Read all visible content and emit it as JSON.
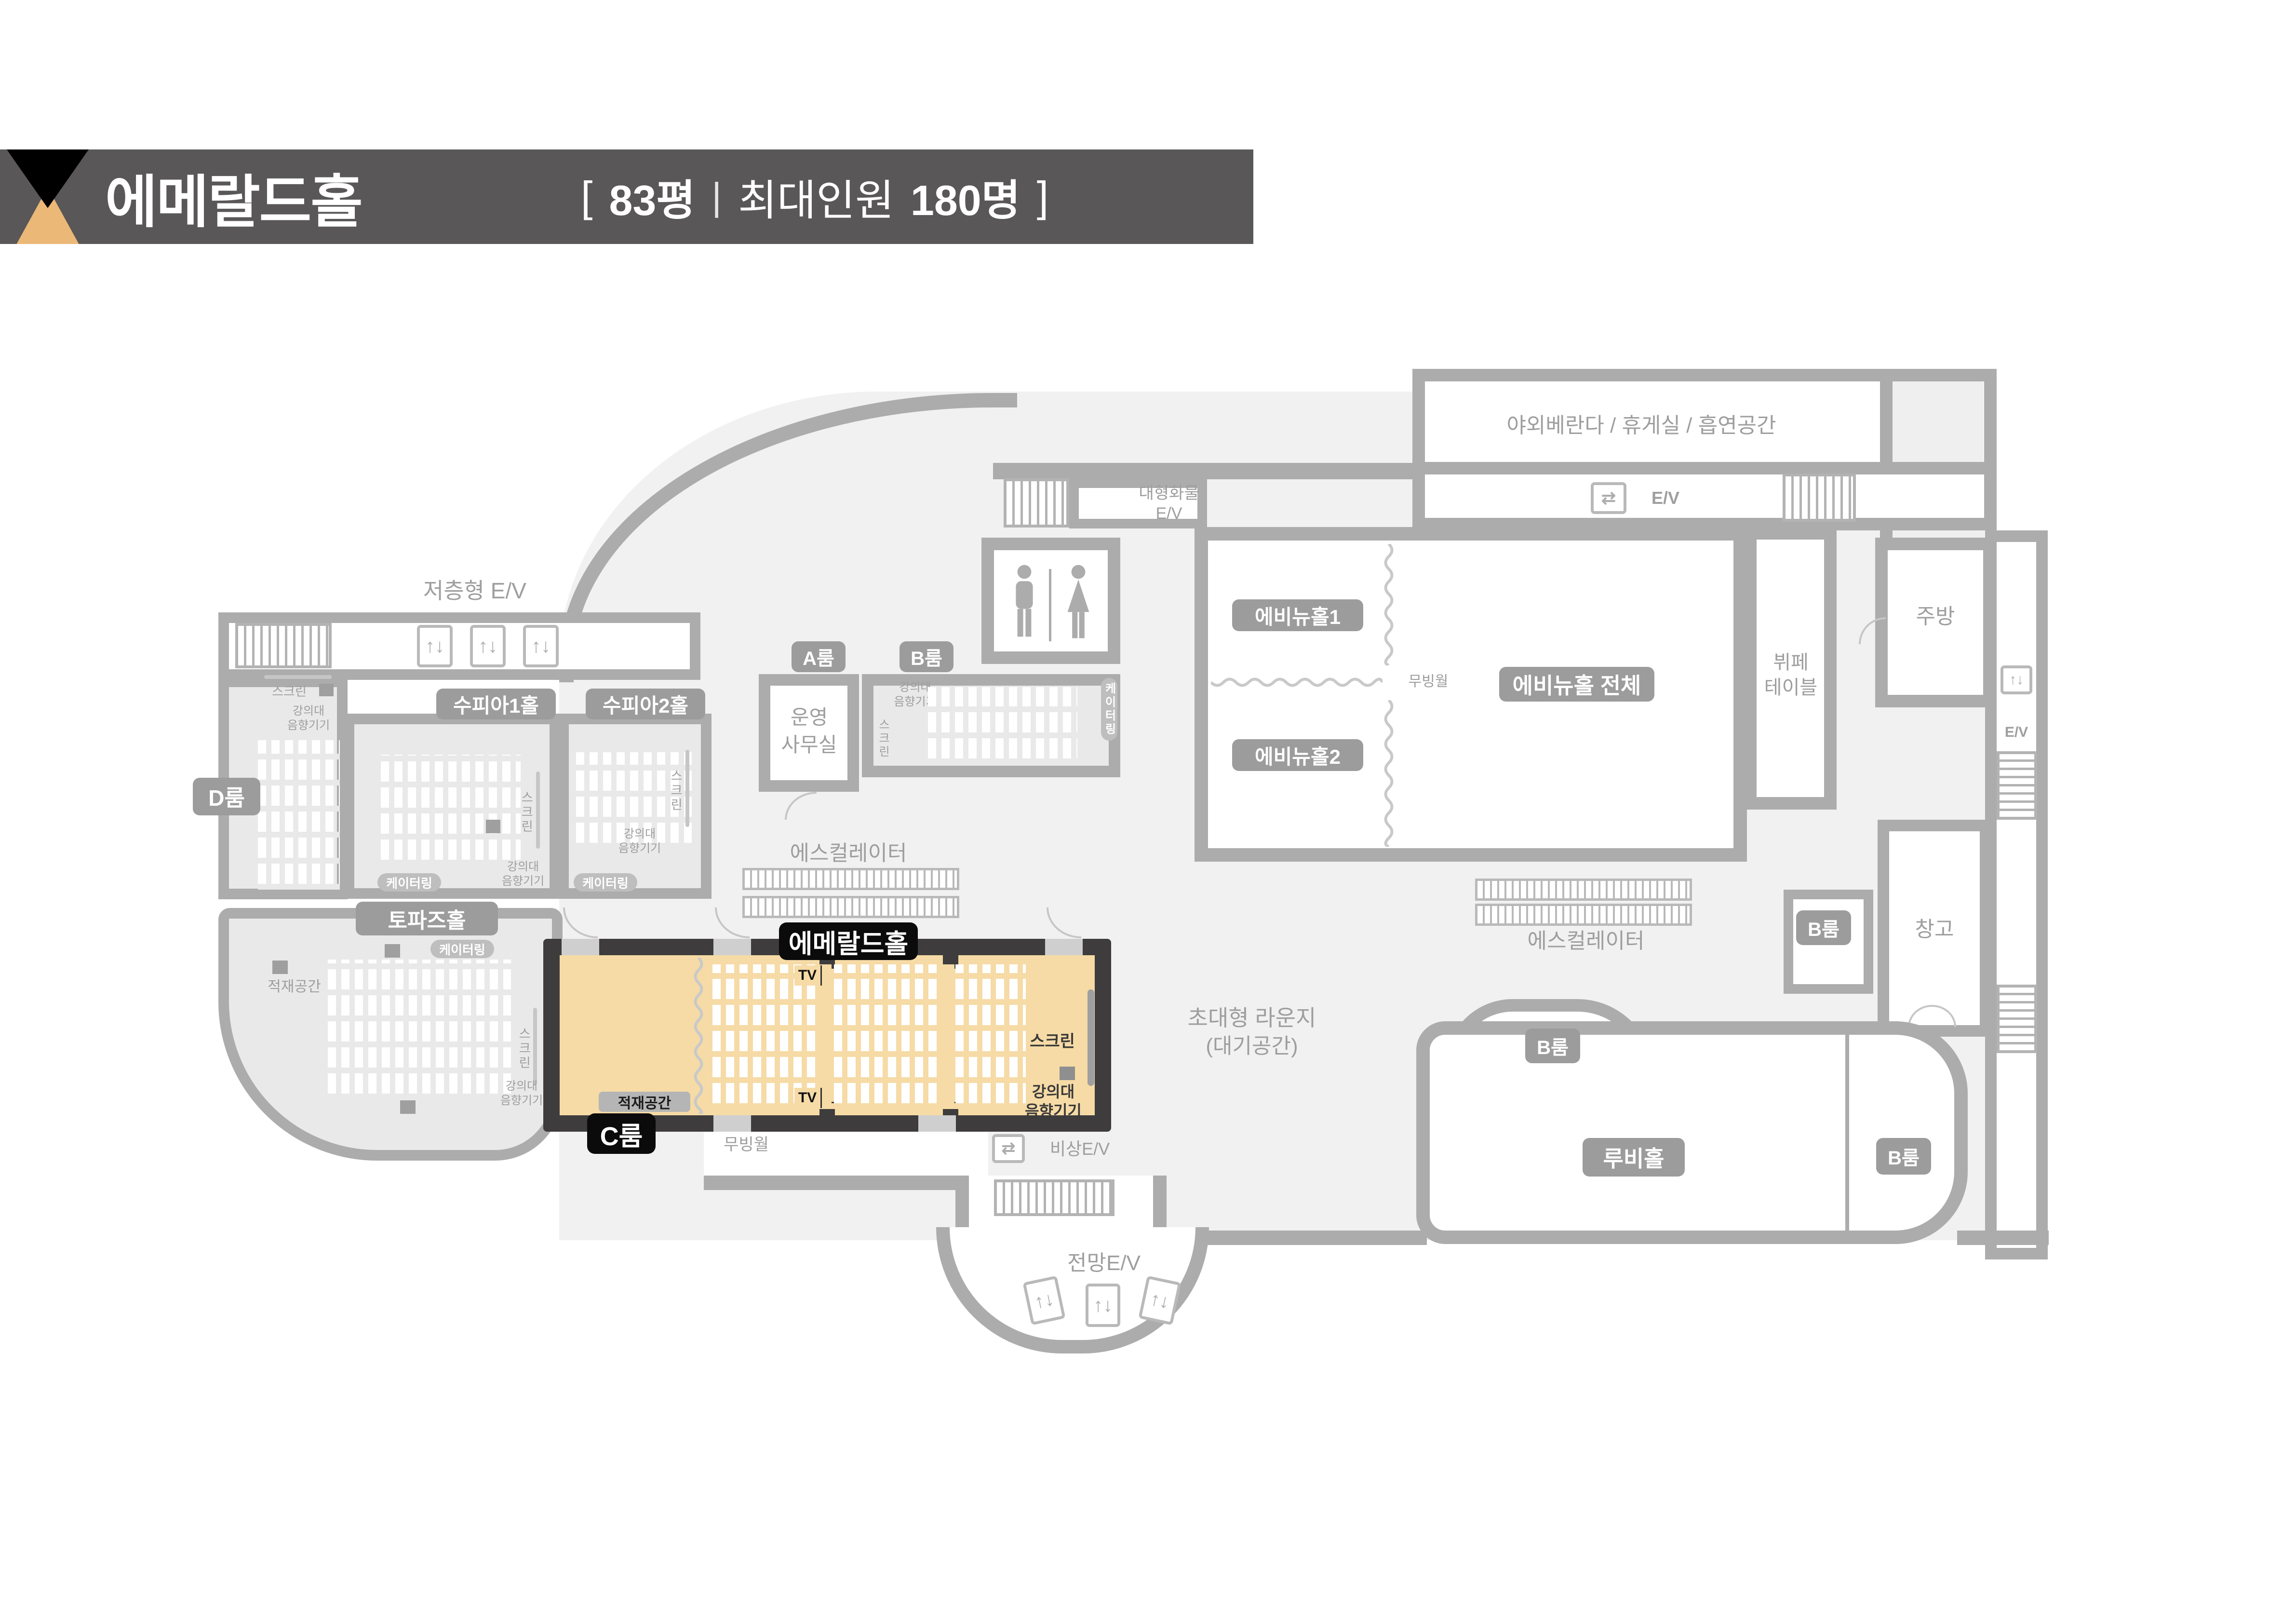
{
  "header": {
    "title": "에메랄드홀",
    "info": {
      "open": "[",
      "area": "83평",
      "divider": "|",
      "capacity_label": "최대인원",
      "capacity_value": "180명",
      "close": "]"
    }
  },
  "colors": {
    "header_bg": "#595757",
    "logo_top": "#000000",
    "logo_bottom": "#EBB878",
    "wall": "#ACACAC",
    "wall_dark": "#3E3C3C",
    "highlight_fill": "#F6DBA6",
    "room_gray": "#E9E9E9",
    "shade": "#F1F1F1",
    "badge_gray": "#9C9C9C",
    "badge_black": "#0B0B0B",
    "text_gray": "#9E9E9E"
  },
  "badges": {
    "emerald": "에메랄드홀",
    "c_room": "C룸",
    "d_room": "D룸",
    "a_room": "A룸",
    "b_room": "B룸",
    "supia1": "수피아1홀",
    "supia2": "수피아2홀",
    "topaz": "토파즈홀",
    "avenue1": "에비뉴홀1",
    "avenue2": "에비뉴홀2",
    "avenue_all": "에비뉴홀 전체",
    "ruby": "루비홀",
    "catering": "케이터링"
  },
  "labels": {
    "low_ev": "저층형 E/V",
    "veranda": "야외베란다 / 휴게실 / 흡연공간",
    "cargo": "대형화물",
    "ev": "E/V",
    "kitchen": "주방",
    "buffet1": "뷔페",
    "buffet2": "테이블",
    "storage": "창고",
    "office1": "운영",
    "office2": "사무실",
    "escalator": "에스컬레이터",
    "lounge1": "초대형 라운지",
    "lounge2": "(대기공간)",
    "view_ev": "전망E/V",
    "emergency_ev": "비상E/V",
    "moving_wall": "무빙월",
    "screen": "스크린",
    "lectern1": "강의대",
    "lectern2": "음향기기",
    "stack": "적재공간",
    "tv": "TV"
  },
  "icons": {
    "elevator_vertical": "↑↓",
    "elevator_horizontal": "⇄"
  }
}
